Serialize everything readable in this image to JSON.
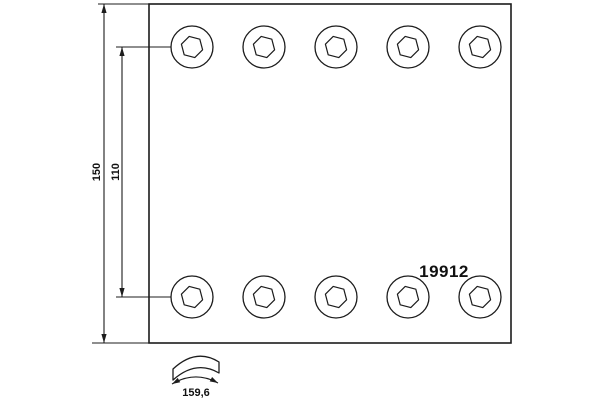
{
  "drawing": {
    "type": "brake-lining-technical-drawing",
    "background_color": "#ffffff",
    "line_color": "#1c1c1c",
    "part": {
      "number": "19912"
    },
    "dimensions": {
      "total_height": "150",
      "hole_row_spacing": "110",
      "arc_width": "159,6"
    },
    "holes": {
      "rows": 2,
      "holes_per_row": 5
    }
  }
}
